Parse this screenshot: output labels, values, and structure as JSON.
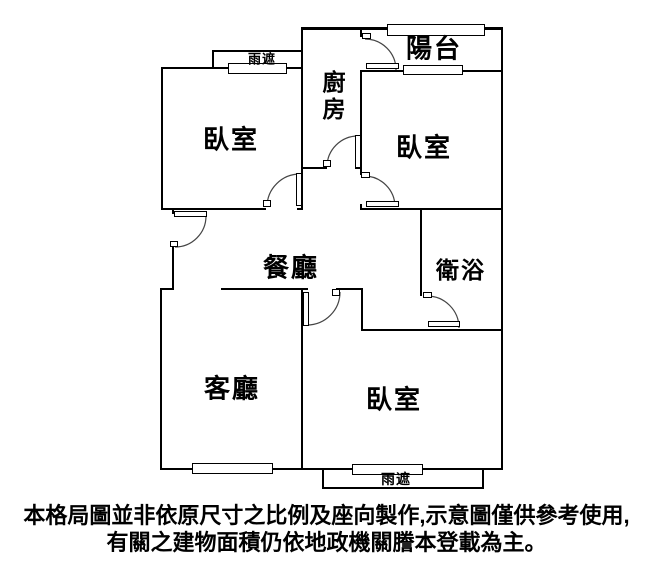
{
  "rooms": {
    "bedroom_top_left": "臥室",
    "kitchen": "廚房",
    "balcony": "陽台",
    "bedroom_top_right": "臥室",
    "dining": "餐廳",
    "bathroom": "衛浴",
    "living": "客廳",
    "bedroom_bottom": "臥室",
    "rain_shield_top": "雨遮",
    "rain_shield_bottom": "雨遮"
  },
  "disclaimer": {
    "line1": "本格局圖並非依原尺寸之比例及座向製作,示意圖僅供參考使用,",
    "line2": "有關之建物面積仍依地政機關謄本登載為主。"
  },
  "colors": {
    "wall": "#000000",
    "background": "#ffffff",
    "text": "#000000",
    "door_arc": "#444444"
  }
}
